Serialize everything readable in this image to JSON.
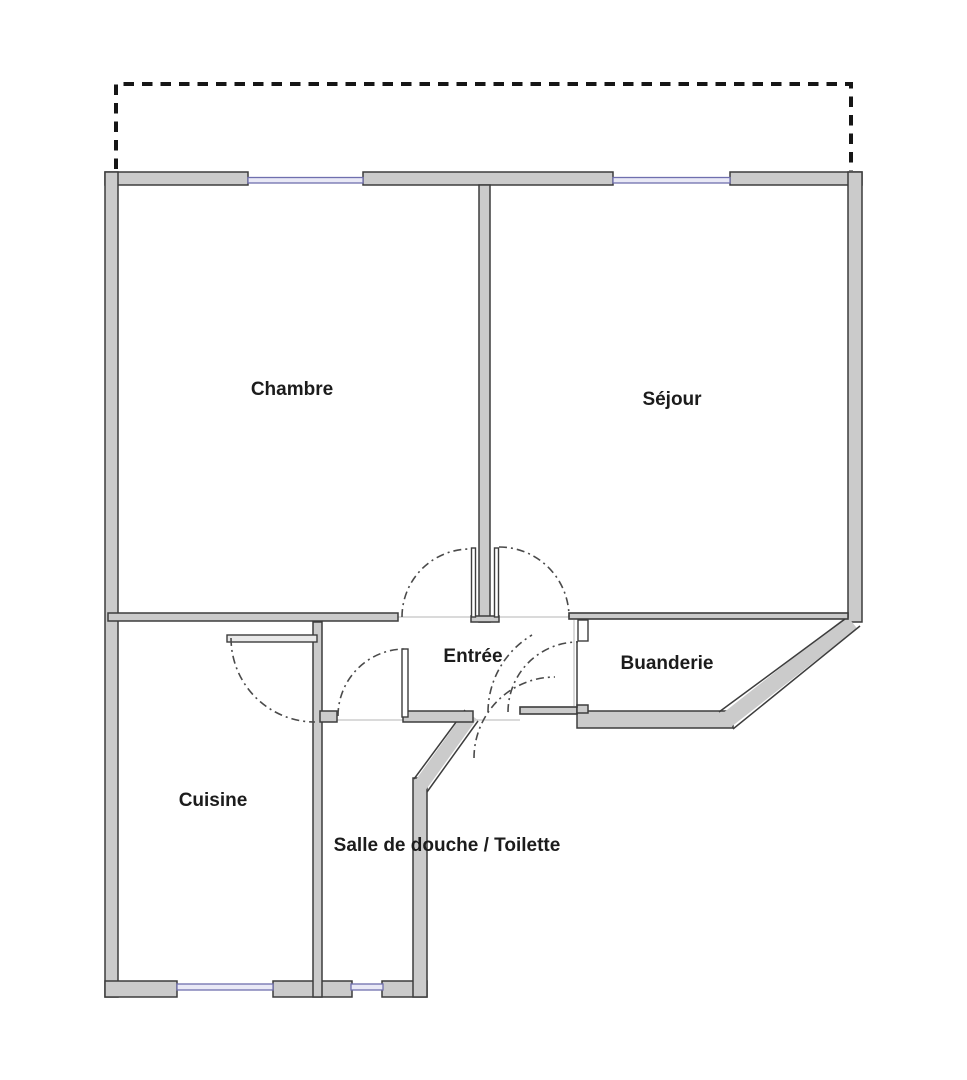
{
  "rooms": [
    {
      "id": "chambre",
      "label": "Chambre"
    },
    {
      "id": "sejour",
      "label": "Séjour"
    },
    {
      "id": "entree",
      "label": "Entrée"
    },
    {
      "id": "buanderie",
      "label": "Buanderie"
    },
    {
      "id": "cuisine",
      "label": "Cuisine"
    },
    {
      "id": "salle_de_douche",
      "label": "Salle de douche / Toilette"
    }
  ],
  "colors": {
    "background": "#ffffff",
    "wall_fill": "#cbcbcb",
    "wall_edge": "#3d3d3d",
    "thin_wall_fill": "#e9e9e9",
    "glass_fill": "#e9e9f6",
    "glass_stroke": "#6f6fae",
    "terrace_dash": "#161616",
    "door_arc": "#4a4a4a",
    "floor_line": "#c3c3c3",
    "label_text": "#1c1c1c"
  }
}
